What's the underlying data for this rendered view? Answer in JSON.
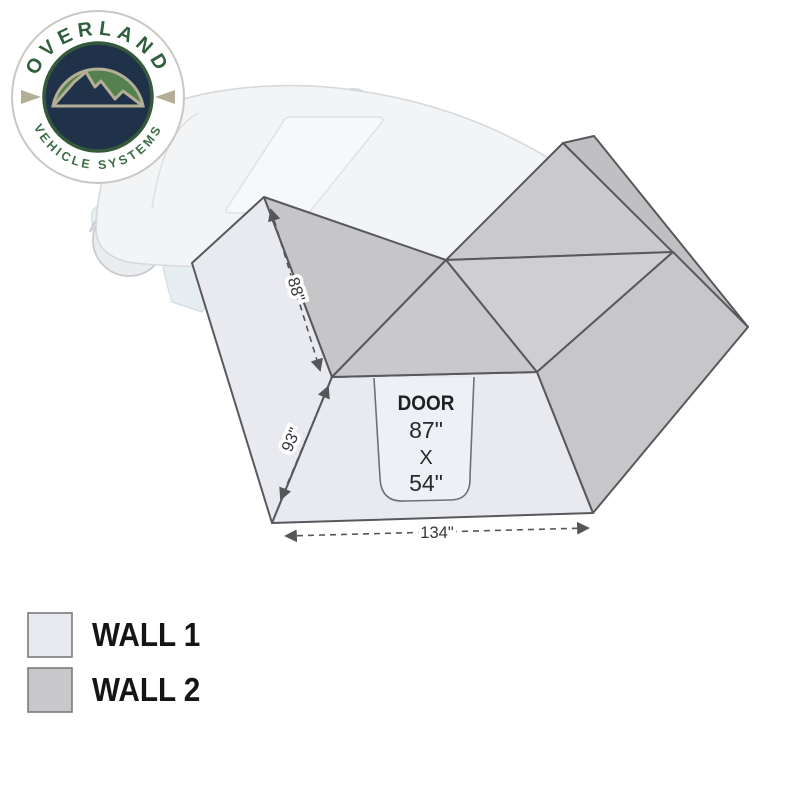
{
  "page": {
    "background": "#ffffff"
  },
  "logo": {
    "arc_top": "OVERLAND",
    "arc_bottom": "VEHICLE SYSTEMS",
    "colors": {
      "text_green": "#2f5f3c",
      "ring_border": "#c9c8c2",
      "navy": "#20324a",
      "dome_green": "#54814e",
      "tan": "#b5ae97"
    }
  },
  "diagram": {
    "dimensions": {
      "edge_upper": "88\"",
      "edge_lower": "93\"",
      "bottom_width": "134\""
    },
    "door": {
      "label": "DOOR",
      "line1": "87\"",
      "line2": "X",
      "line3": "54\""
    },
    "colors": {
      "wall1": "#e9e9f0",
      "wall2": "#c8c8ca",
      "outline": "#58595d",
      "dimension": "#4a4b4e",
      "vehicle_fill": "#f3f4f6",
      "vehicle_stroke": "#d6d9dc"
    }
  },
  "legend": {
    "items": [
      {
        "label": "WALL 1",
        "color": "#e8e8ef"
      },
      {
        "label": "WALL 2",
        "color": "#c8c8ca"
      }
    ]
  }
}
